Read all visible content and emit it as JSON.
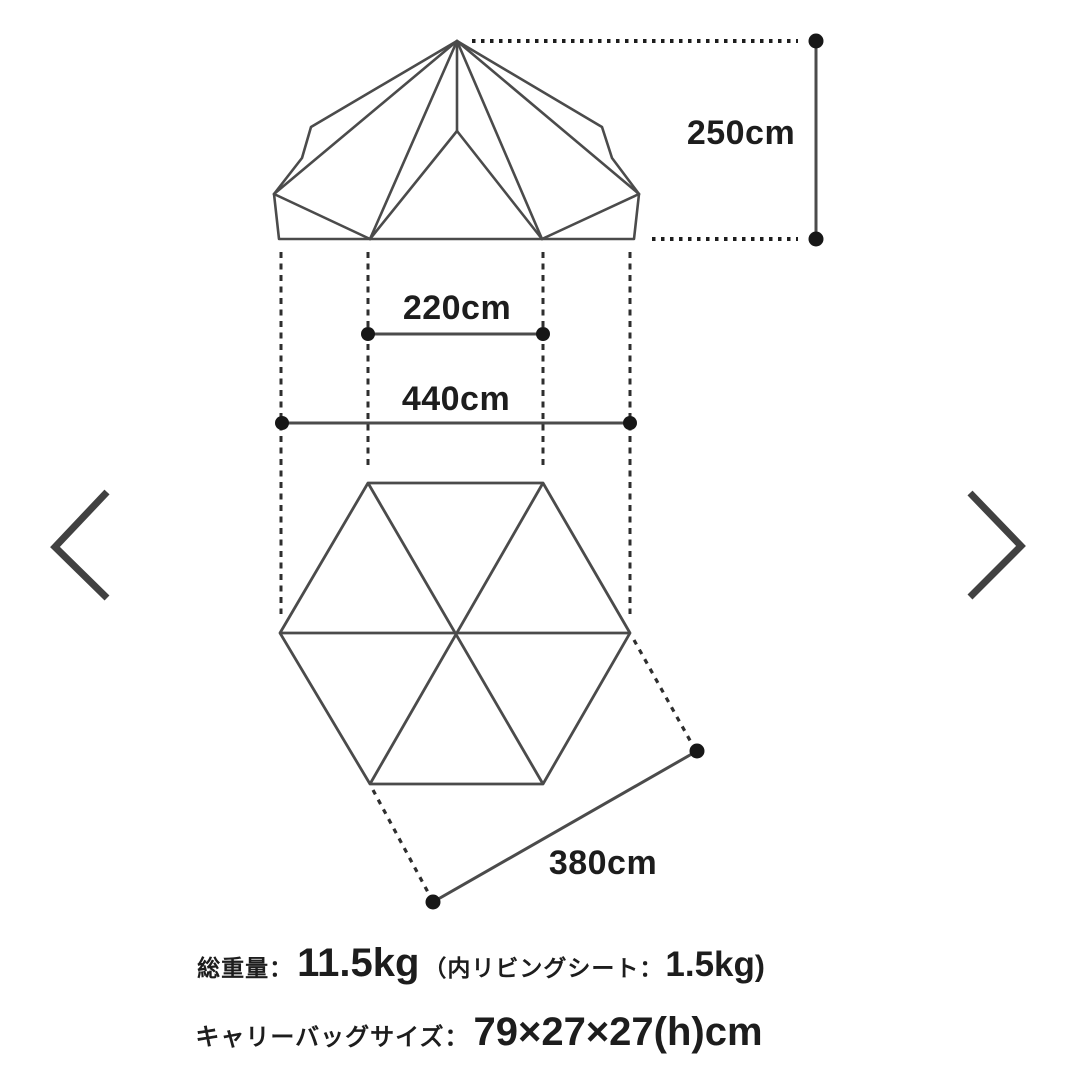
{
  "carousel": {
    "prev_icon": "chevron-left",
    "next_icon": "chevron-right"
  },
  "diagram": {
    "height_label": "250cm",
    "inner_width_label": "220cm",
    "outer_width_label": "440cm",
    "side_length_label": "380cm"
  },
  "specs": {
    "weight_label": "総重量：",
    "weight_value": "11.5kg",
    "weight_note_prefix": "（内リビングシート：",
    "weight_note_value": "1.5kg",
    "weight_note_suffix": ")",
    "bag_label": "キャリーバッグサイズ：",
    "bag_value": "79×27×27(h)cm"
  },
  "colors": {
    "line": "#4b4b4b",
    "text": "#1d1d1d",
    "dot": "#171717",
    "chevron": "#414141",
    "background": "#ffffff"
  }
}
